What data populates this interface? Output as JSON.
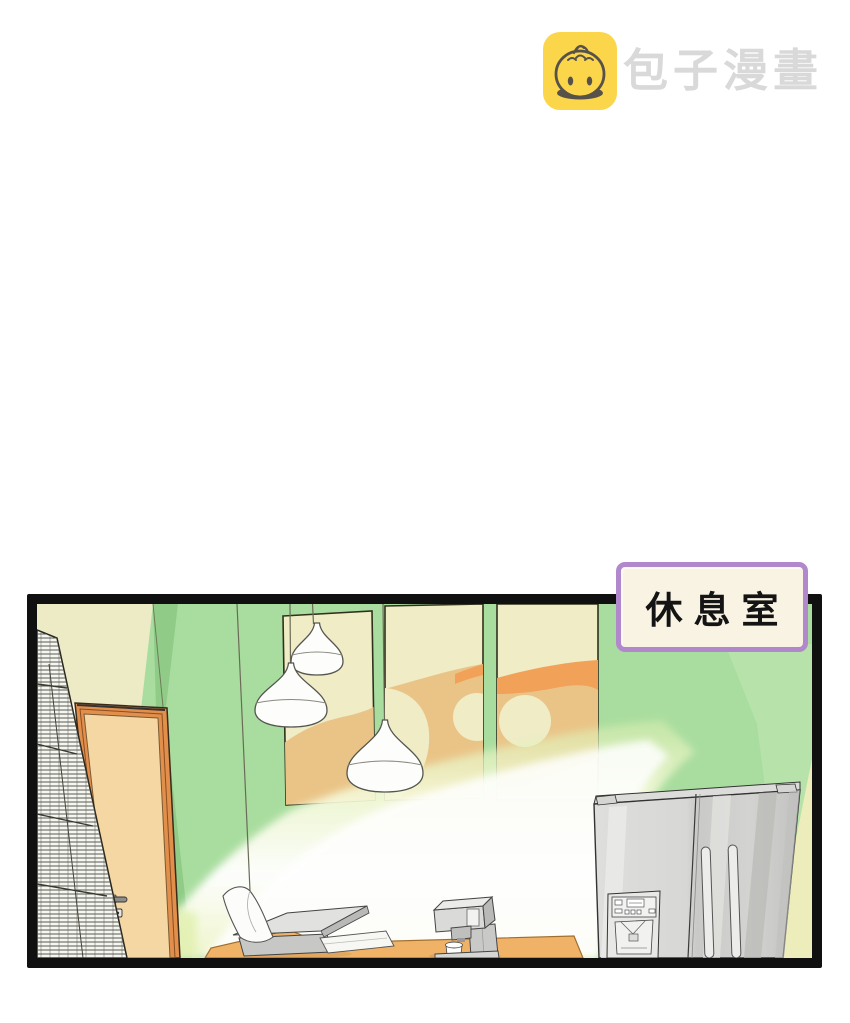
{
  "watermark": {
    "brand_text": "包子漫畫",
    "icon": "baozi-bun-icon",
    "icon_bg_color": "#fbd54a",
    "icon_glyph_color": "#56524a",
    "text_color": "#d9d9d9"
  },
  "panel": {
    "label": "休息室",
    "label_bg": "#f8f3e2",
    "label_border_color": "#b288cc",
    "label_text_color": "#141414",
    "border_color": "#101010"
  },
  "scene": {
    "description": "break room interior illustration",
    "objects": [
      "hatched-shelf",
      "door",
      "pendant-lamps",
      "wall-art-panels",
      "light-beam",
      "desk",
      "printer",
      "paper-sheet",
      "coffee-machine",
      "mug",
      "refrigerator"
    ],
    "colors": {
      "wall_green": "#a9dd9f",
      "wall_green_shaded": "#90cc88",
      "wall_green_light": "#b7e3ab",
      "wall_cream": "#ecebc6",
      "door_fill": "#f5d7a3",
      "door_frame": "#e28f4c",
      "desk": "#f0b267",
      "art_tan": "#eac487",
      "art_orange": "#f1a158",
      "fridge_gray": "#d4d4d2",
      "light_beam": "#ffffff"
    }
  }
}
